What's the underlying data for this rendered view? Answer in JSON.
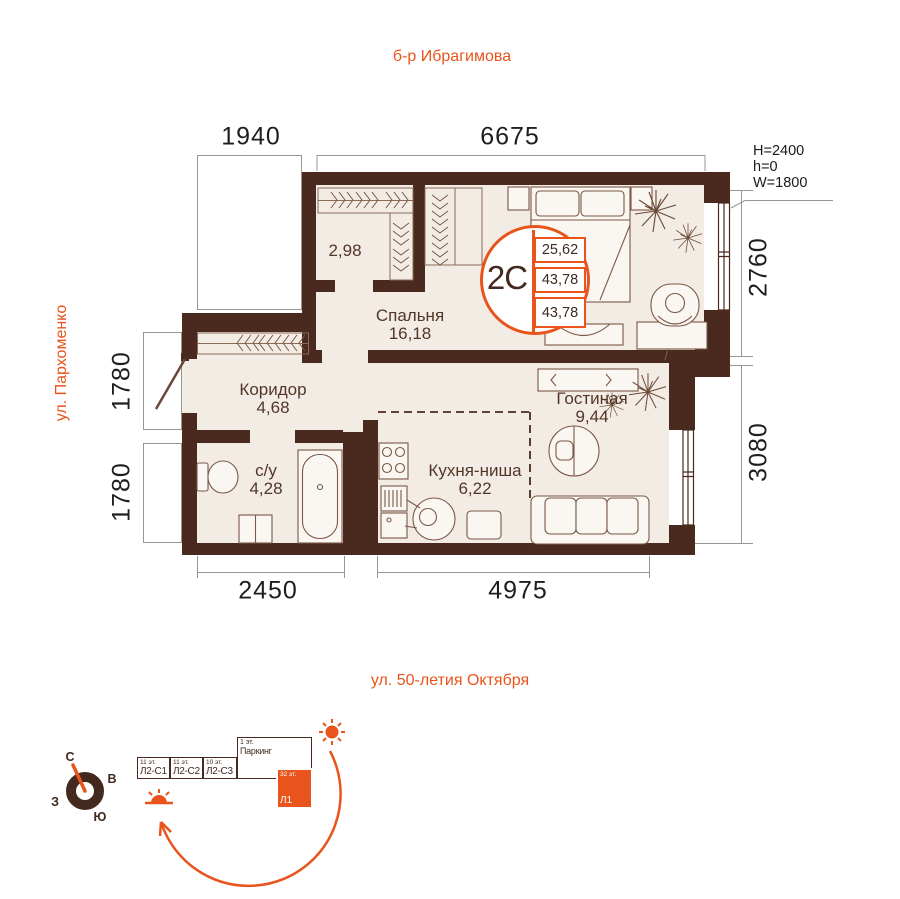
{
  "streets": {
    "top": "б-р Ибрагимова",
    "left": "ул. Пархоменко",
    "bottom": "ул. 50-летия Октября"
  },
  "dimensions": {
    "top_section": "1940",
    "top_main": "6675",
    "right_upper": "2760",
    "right_lower": "3080",
    "left_upper": "1780",
    "left_lower": "1780",
    "bottom_left": "2450",
    "bottom_right": "4975"
  },
  "window_params": {
    "height": "H=2400",
    "sill": "h=0",
    "width": "W=1800"
  },
  "unit_badge": {
    "type": "2С",
    "values": [
      "25,62",
      "43,78",
      "43,78"
    ]
  },
  "rooms": {
    "wardrobe": {
      "area": "2,98"
    },
    "bedroom": {
      "name": "Спальня",
      "area": "16,18"
    },
    "corridor": {
      "name": "Коридор",
      "area": "4,68"
    },
    "bathroom": {
      "name": "с/у",
      "area": "4,28"
    },
    "kitchen": {
      "name": "Кухня-ниша",
      "area": "6,22"
    },
    "living": {
      "name": "Гостиная",
      "area": "9,44"
    }
  },
  "compass": {
    "north": "С",
    "east": "В",
    "west": "З",
    "south": "Ю"
  },
  "site_plan": {
    "buildings": [
      {
        "floors": "11 эт.",
        "label": "Л2-С1"
      },
      {
        "floors": "11 эт.",
        "label": "Л2-С2"
      },
      {
        "floors": "10 эт.",
        "label": "Л2-С3"
      }
    ],
    "parking": {
      "floors": "1 эт.",
      "label": "Паркинг"
    },
    "tower": {
      "floors": "32 эт.",
      "label": "Л1"
    }
  },
  "colors": {
    "wall": "#4a2a1f",
    "accent": "#e8541c",
    "floor": "#f2ece4",
    "furniture": "#7b5847"
  }
}
